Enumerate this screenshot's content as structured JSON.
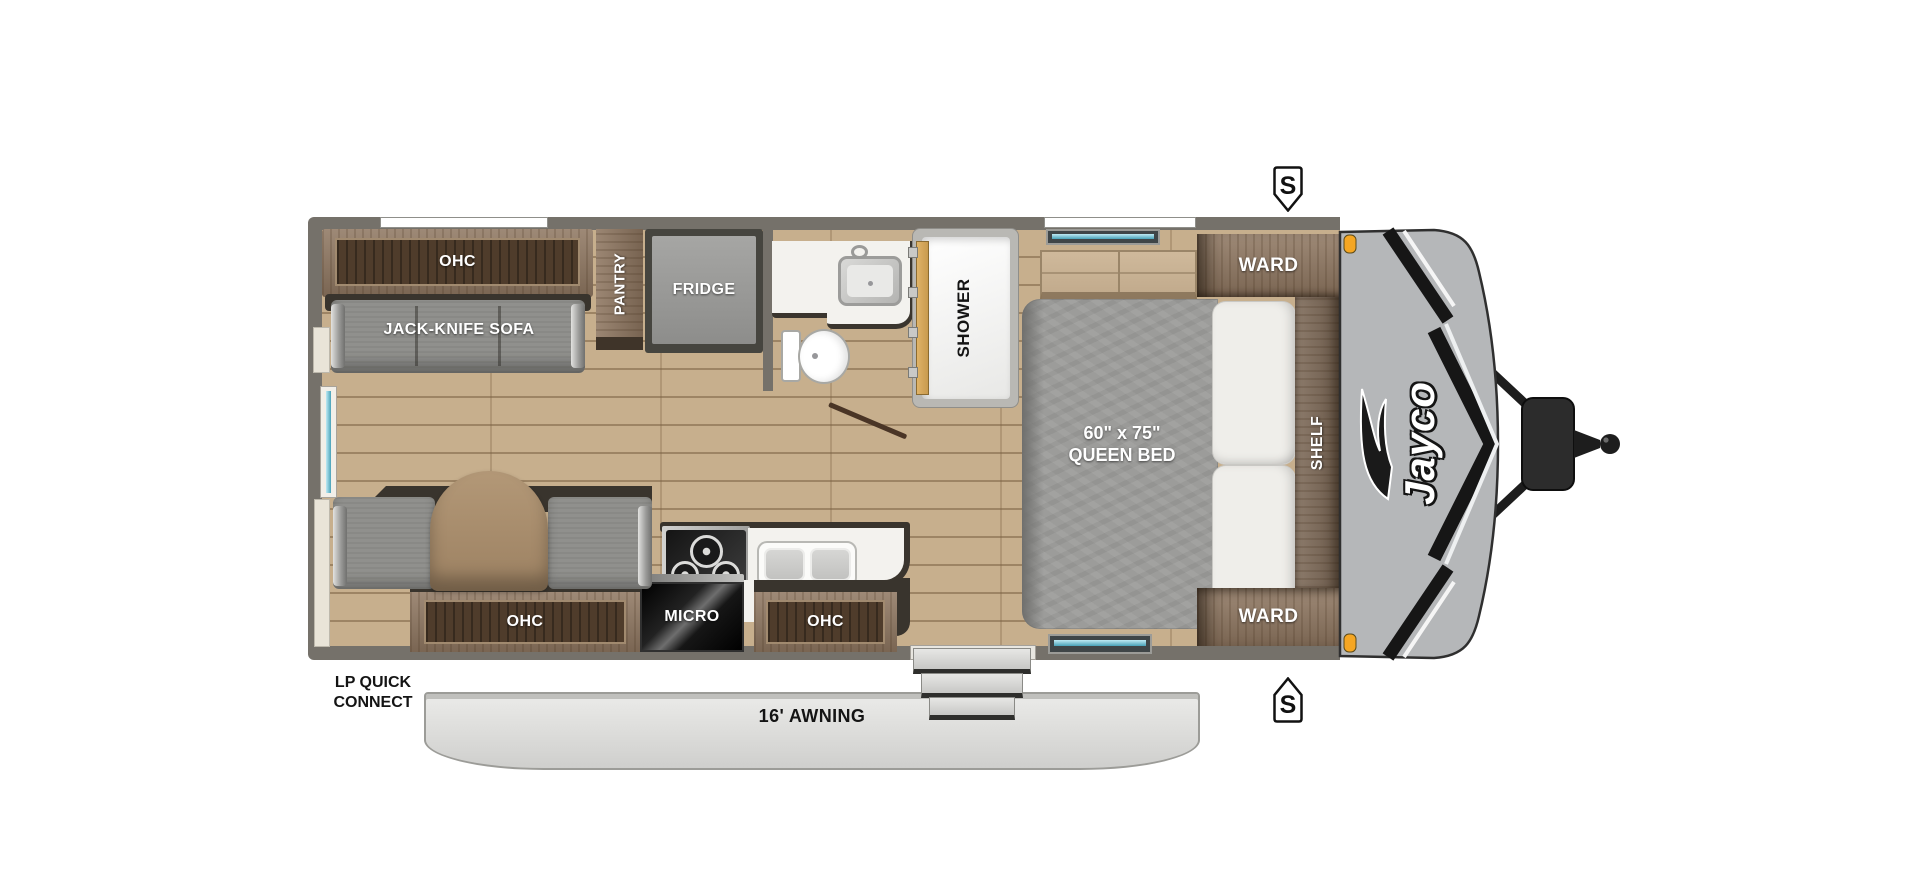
{
  "labels": {
    "ohc_top": "OHC",
    "jack_knife_sofa": "JACK-KNIFE SOFA",
    "pantry": "PANTRY",
    "fridge": "FRIDGE",
    "shower": "SHOWER",
    "ward_top": "WARD",
    "bed_size": "60\" x 75\"",
    "bed_name": "QUEEN BED",
    "shelf": "SHELF",
    "ward_bottom": "WARD",
    "ohc_rear": "OHC",
    "micro": "MICRO",
    "ohc_entry": "OHC",
    "awning": "16' AWNING",
    "lp_line1": "LP QUICK",
    "lp_line2": "CONNECT",
    "speaker_top": "S",
    "speaker_bottom": "S",
    "brand": "Jayco"
  },
  "colors": {
    "wall_gray": "#75716a",
    "floor_wood": "#c7af8d",
    "cabinet_wood": "#8e7660",
    "cabinet_inner_wood": "#4f3c2b",
    "upholstery_gray": "#90908d",
    "dark_trim": "#39342d",
    "counter_white": "#f3f2ee",
    "shower_door_tan": "#d8a95c",
    "front_cap_gray": "#b5b7b9",
    "accent_black": "#161616",
    "awning_gray": "#dedddb",
    "window_glass_teal": "#7fcbdd",
    "marker_light_orange": "#f5a623"
  }
}
